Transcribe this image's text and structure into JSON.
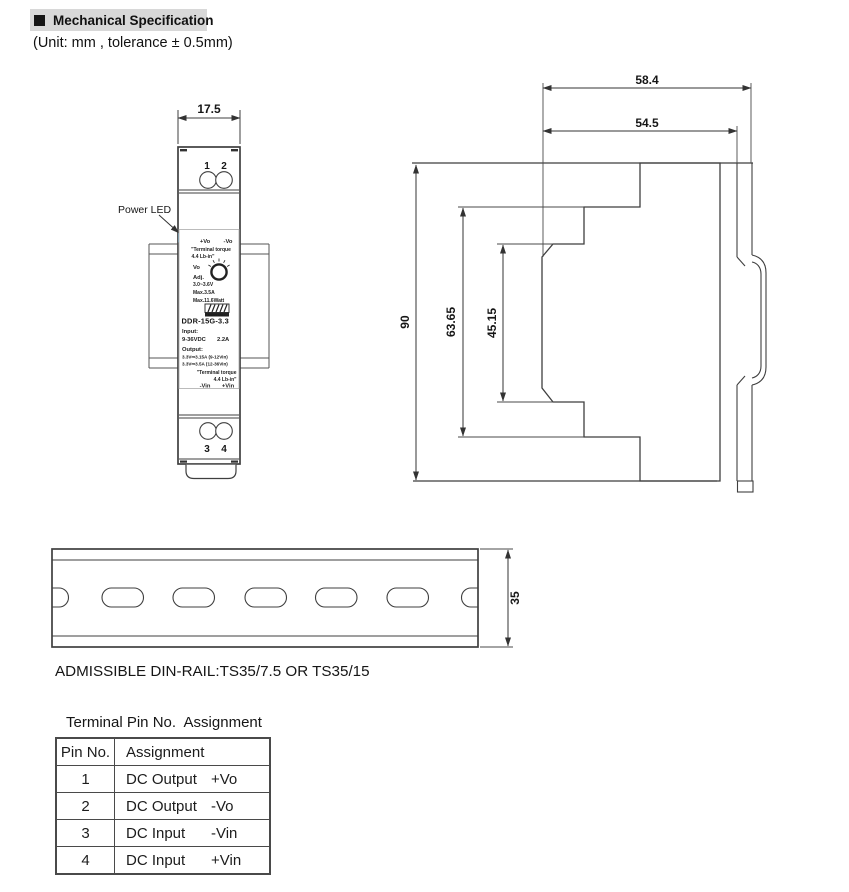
{
  "page": {
    "section_title": "Mechanical Specification",
    "unit_note": "(Unit: mm , tolerance ± 0.5mm)"
  },
  "front_view": {
    "width_dim": "17.5",
    "power_led_label": "Power LED",
    "terminal_1": "1",
    "terminal_2": "2",
    "terminal_3": "3",
    "terminal_4": "4",
    "label": {
      "vo_plus": "+Vo",
      "vo_minus": "-Vo",
      "torque_line1": "\"Terminal torque",
      "torque_line2": "4.4 Lb-in\"",
      "vo": "Vo",
      "adj": "Adj.",
      "adj_range": "3.0~3.6V",
      "max_current": "Max.3.5A",
      "max_power": "Max.11.6Watt",
      "brand": "MEAN WELL",
      "model": "DDR-15G-3.3",
      "input_label": "Input:",
      "input_voltage": "9-36VDC",
      "input_current": "2.2A",
      "output_label": "Output:",
      "output_line1": "3.3V⎓3.15A (9-12Vin)",
      "output_line2": "3.3V⎓3.5A (12-36Vin)",
      "torque2_line1": "\"Terminal torque",
      "torque2_line2": "4.4 Lb-in\"",
      "vin_minus": "-Vin",
      "vin_plus": "+Vin"
    }
  },
  "side_view": {
    "dims": {
      "depth_with_rail": "58.4",
      "depth_case": "54.5",
      "height": "90",
      "body_step": "63.65",
      "recess": "45.15"
    }
  },
  "rail_view": {
    "width_dim": "35",
    "admissible_note": "ADMISSIBLE DIN-RAIL:TS35/7.5 OR TS35/15"
  },
  "pin_table": {
    "title": "Terminal Pin No.  Assignment",
    "headers": [
      "Pin No.",
      "Assignment"
    ],
    "rows": [
      {
        "pin": "1",
        "function": "DC Output",
        "signal": "+Vo"
      },
      {
        "pin": "2",
        "function": "DC Output",
        "signal": "-Vo"
      },
      {
        "pin": "3",
        "function": "DC Input",
        "signal": "-Vin"
      },
      {
        "pin": "4",
        "function": "DC Input",
        "signal": "+Vin"
      }
    ]
  },
  "colors": {
    "header_bg": "#d8d8d8",
    "line": "#3f3f3f",
    "led_blue": "#8cc6e4",
    "teal_terminal": "#1d9e9e"
  }
}
